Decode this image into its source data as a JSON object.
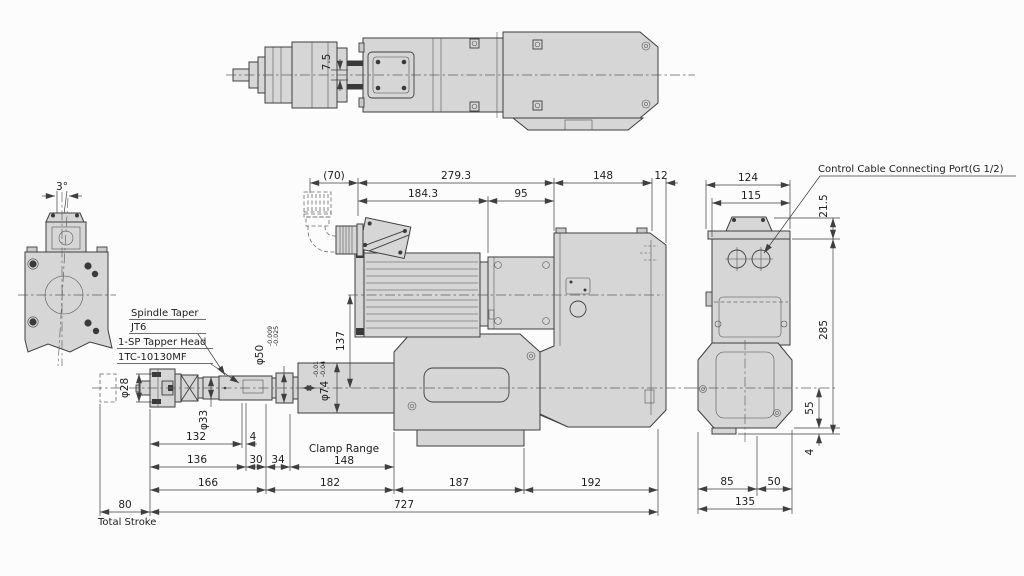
{
  "colors": {
    "body_fill": "#d5d6d5",
    "edge_line": "#3e3e3e",
    "background": "#fcfcfc"
  },
  "labels": {
    "control_cable_port": "Control Cable Connecting Port(G 1/2)",
    "spindle_taper": "Spindle Taper",
    "spindle_taper_value": "JT6",
    "tapper_head": "1-SP Tapper Head",
    "tapper_head_model": "1TC-10130MF",
    "clamp_range": "Clamp Range",
    "total_stroke": "Total Stroke"
  },
  "dims": {
    "top_view": {
      "connector_offset": "7.5"
    },
    "left_view": {
      "tilt_angle": "3°"
    },
    "front_top": {
      "cable_clearance": "(70)",
      "motor_overall": "279.3",
      "body_width": "148",
      "end_cap": "12",
      "motor_section": "184.3",
      "gear_section": "95"
    },
    "front_axis_offset": "137",
    "diameters": {
      "chuck": "φ28",
      "neck": "φ33",
      "pilot": "φ50",
      "pilot_tol_upper": "-0.009",
      "pilot_tol_lower": "-0.025",
      "quill": "φ74",
      "quill_tol_upper": "-0.01",
      "quill_tol_lower": "-0.04"
    },
    "front_bottom": {
      "seg_132": "132",
      "seg_4": "4",
      "seg_136": "136",
      "seg_30": "30",
      "seg_34": "34",
      "clamp_range_length": "148",
      "seg_166": "166",
      "seg_182": "182",
      "seg_187": "187",
      "seg_192": "192",
      "total_stroke_length": "80",
      "overall_length": "727"
    },
    "side_view": {
      "width_overall": "124",
      "width_body": "115",
      "port_offset": "21.5",
      "height": "285",
      "axis_to_base": "55",
      "base_plate": "4",
      "base_left": "85",
      "base_right": "50",
      "base_overall": "135"
    }
  }
}
